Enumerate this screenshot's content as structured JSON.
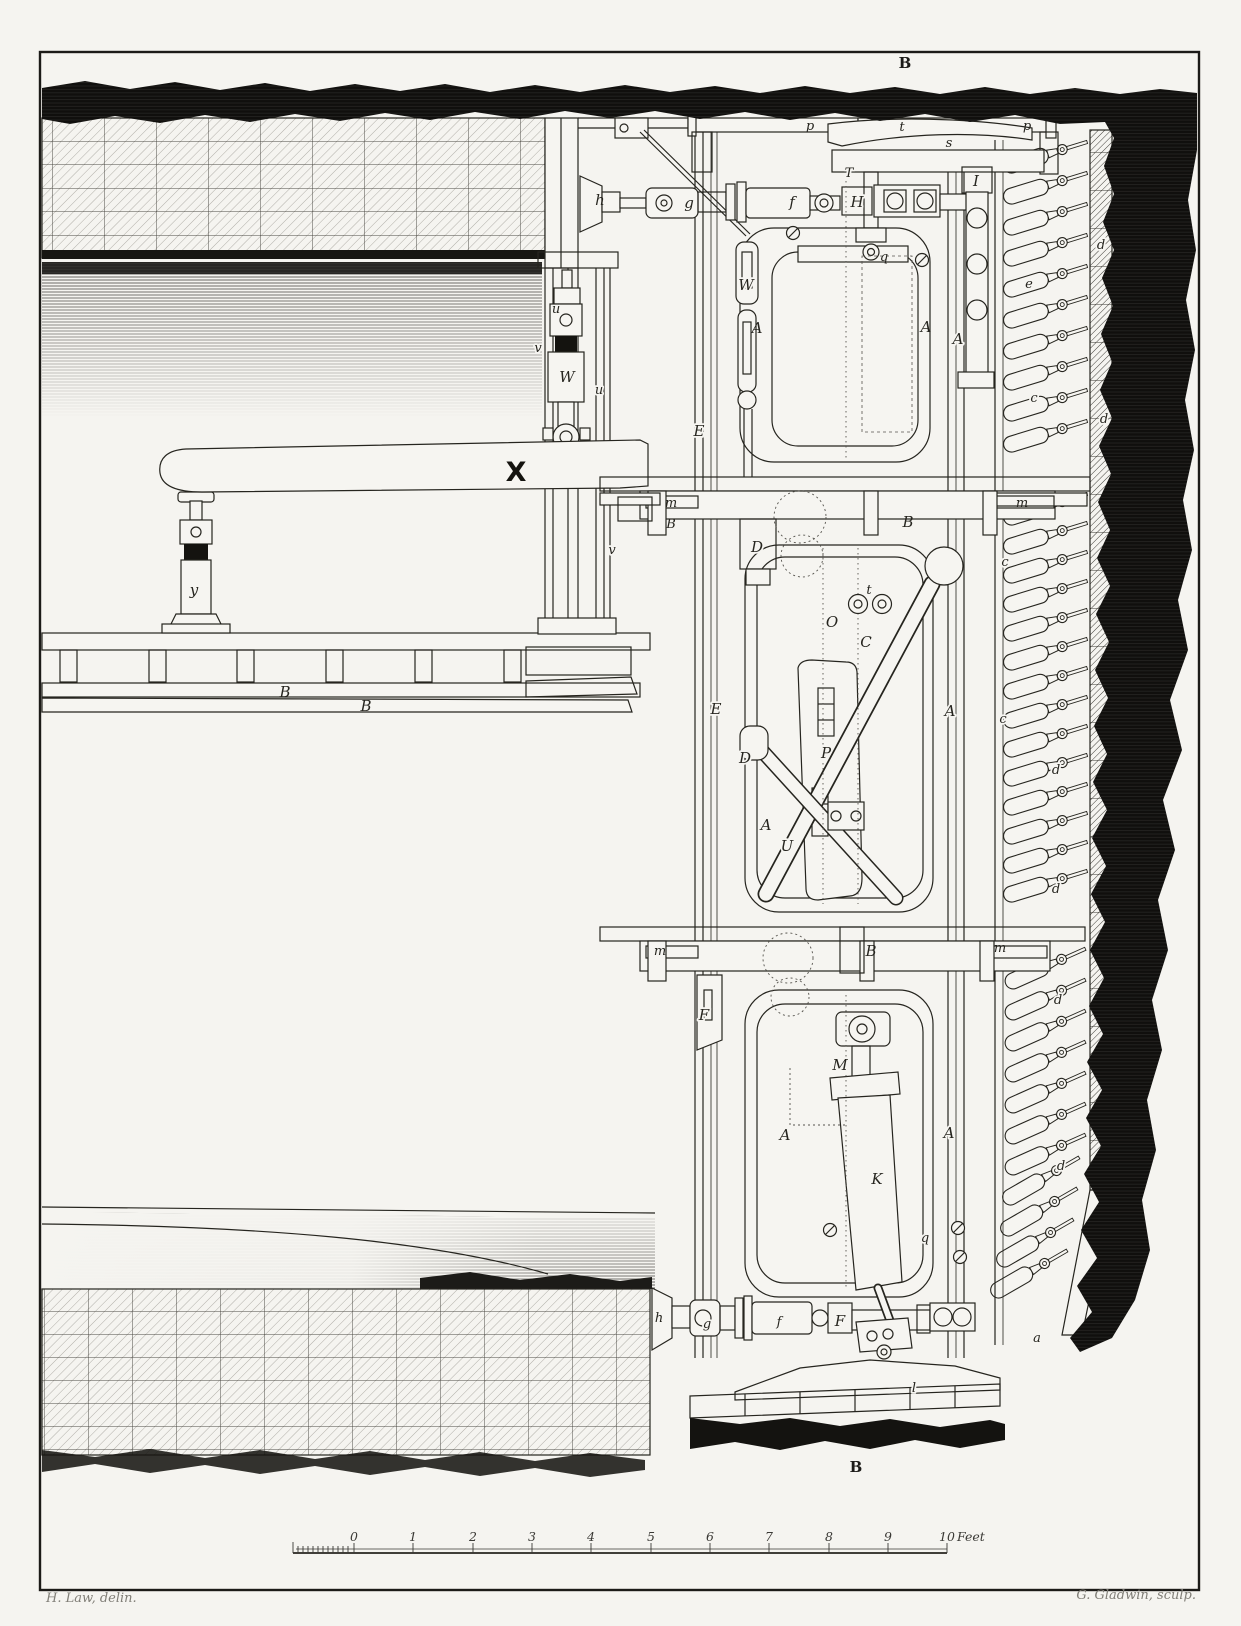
{
  "plate": {
    "top_mark": "B",
    "bottom_mark": "B",
    "credit_left": "H. Law, delin.",
    "credit_right": "G. Gladwin, sculp."
  },
  "scale_bar": {
    "ticks": [
      "0",
      "1",
      "2",
      "3",
      "4",
      "5",
      "6",
      "7",
      "8",
      "9",
      "10"
    ],
    "unit": "Feet"
  },
  "colors": {
    "paper": "#f5f4f0",
    "ink": "#26251f",
    "earth": "#100f0d"
  },
  "labels": {
    "h_upper": "h",
    "g_upper": "g",
    "f_upper": "f",
    "H_upper": "H",
    "T_upper": "T",
    "I_bar": "I",
    "t_shoe": "t",
    "s_top": "s",
    "p_left": "p",
    "p_right": "p",
    "q_upper": "q",
    "W_link": "W",
    "A_upper_left": "A",
    "A_upper_right": "A",
    "u_1": "u",
    "v_1": "v",
    "W_jack": "W",
    "u_2": "u",
    "v_2": "v",
    "X_stage": "X",
    "y_prop": "y",
    "B_deck_1": "B",
    "B_deck_2": "B",
    "m_floor1_left": "m",
    "m_floor1_right": "m",
    "B_floor1_left": "B",
    "B_floor1_right": "B",
    "D_block": "D",
    "E_1": "E",
    "E_2": "E",
    "O_mid": "O",
    "C_mid": "C",
    "t_mid": "t",
    "P_mid": "P",
    "D_joint": "D",
    "A_mid_left": "A",
    "A_mid_right": "A",
    "U_mid": "U",
    "m_floor2_left": "m",
    "B_floor2": "B",
    "m_floor2_right": "m",
    "F_bracket": "F",
    "M_screw": "M",
    "K_jack": "K",
    "A_low_left": "A",
    "A_low_right": "A",
    "q_lower": "q",
    "h_lower": "h",
    "g_lower": "g",
    "f_lower": "f",
    "F_lower": "F",
    "l_foot": "l",
    "a_foot": "a",
    "e_right": "e",
    "c_1": "c",
    "c_2": "c",
    "c_3": "c",
    "A_right": "A",
    "d_1": "d",
    "d_2": "d",
    "d_3": "d",
    "d_4": "d",
    "d_5": "d",
    "d_6": "d"
  }
}
